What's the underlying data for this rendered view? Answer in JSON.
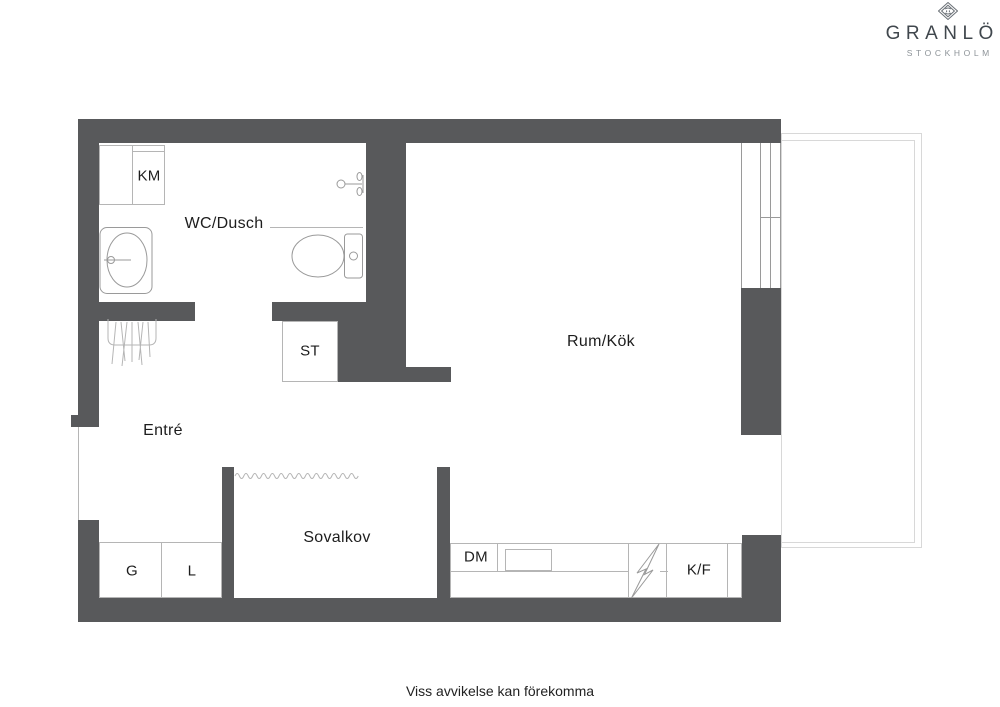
{
  "logo": {
    "name": "GRANLÖF",
    "city": "STOCKHOLM",
    "icon": "diamond-monogram-icon"
  },
  "labels": {
    "km": "KM",
    "wc": "WC/Dusch",
    "st": "ST",
    "entre": "Entré",
    "rum": "Rum/Kök",
    "sovalkov": "Sovalkov",
    "g": "G",
    "l": "L",
    "dm": "DM",
    "kf": "K/F"
  },
  "footer": {
    "disclaimer": "Viss avvikelse kan förekomma"
  },
  "colors": {
    "wall": "#58595b",
    "box": "#b5b5b5",
    "line": "#c6c6c6",
    "fixture": "#9a9a9a",
    "balcony": "#d8d8d8",
    "text": "#1d1d1d",
    "logo_dark": "#40474d",
    "logo_mid": "#6b7177",
    "logo_light": "#8d9398"
  }
}
